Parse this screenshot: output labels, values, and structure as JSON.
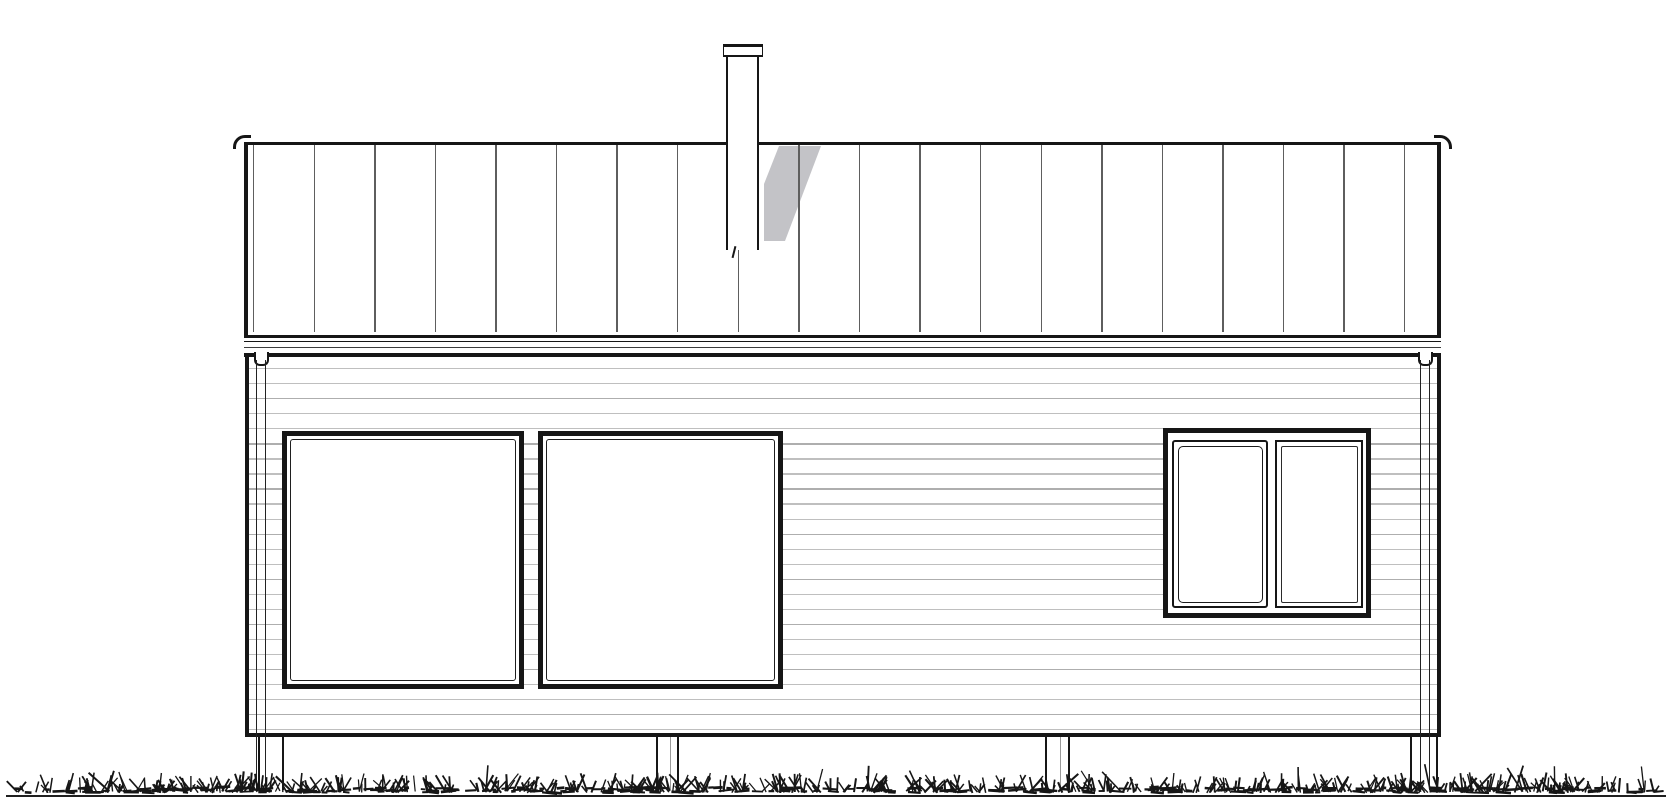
{
  "page": {
    "title": "Architectural side elevation drawing of a small single-storey cabin on post foundations",
    "background": "#ffffff"
  },
  "colors": {
    "ink": "#161616",
    "seam_line": "#5e5e5e",
    "siding_line": "#bfbfbf",
    "siding_line_alt": "#aeaeae",
    "shadow": "#c3c3c7",
    "ground": "#1f1f1f"
  },
  "drawing": {
    "roof": {
      "label": "standing-seam roof with vertical panel joints",
      "seam_count": 20,
      "seam_start_x": 253,
      "seam_spacing": 60.58
    },
    "chimney": {
      "label": "metal chimney flue with rain cap"
    },
    "chimney_shadow_polygon": [
      [
        775,
        146
      ],
      [
        817,
        146
      ],
      [
        781,
        241
      ],
      [
        760,
        241
      ],
      [
        760,
        184
      ]
    ],
    "wall": {
      "label": "horizontal clapboard siding",
      "siding_line_count": 25,
      "siding_start_y": 368,
      "siding_spacing": 15.05
    },
    "windows": {
      "large": [
        {
          "label": "large fixed picture window left"
        },
        {
          "label": "large fixed picture window right"
        }
      ],
      "small_set": {
        "label": "two-pane window with openable casement and fixed pane"
      }
    },
    "downpipes": [
      {
        "side": "left"
      },
      {
        "side": "right"
      }
    ],
    "posts": [
      {
        "x": 258,
        "w": 26,
        "mid": false
      },
      {
        "x": 656,
        "w": 23,
        "mid": true
      },
      {
        "x": 1045,
        "w": 25,
        "mid": true
      },
      {
        "x": 1410,
        "w": 28,
        "mid": false
      }
    ],
    "grass": {
      "label": "grass ground line",
      "seed": 11,
      "blade_count": 560,
      "clump_count": 270,
      "ground_line_y": 796
    }
  }
}
